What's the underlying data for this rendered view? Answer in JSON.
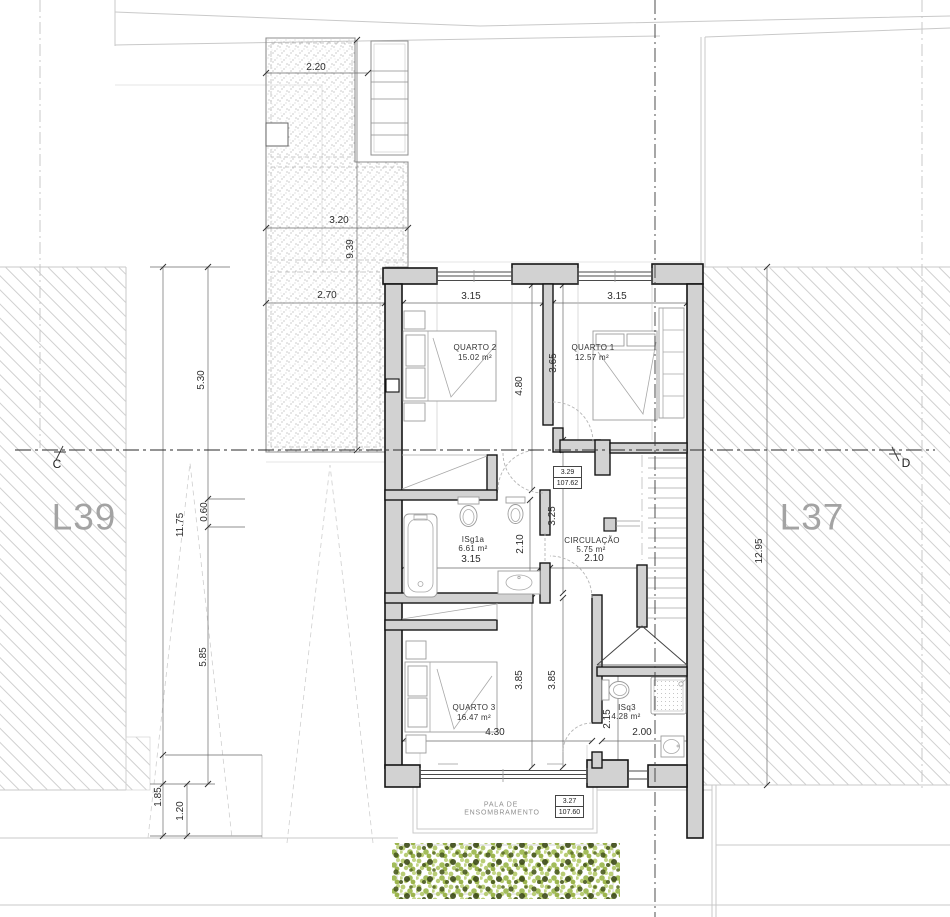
{
  "plan": {
    "lots": {
      "left": "L39",
      "right": "L37"
    },
    "section": {
      "left": "C",
      "right": "D"
    },
    "rooms": {
      "quarto2": {
        "name": "QUARTO 2",
        "area": "15.02 m²"
      },
      "quarto1": {
        "name": "QUARTO 1",
        "area": "12.57 m²"
      },
      "isg1a": {
        "name": "ISg1a",
        "area": "6.61 m²"
      },
      "circulacao": {
        "name": "CIRCULAÇÃO",
        "area": "5.75 m²"
      },
      "quarto3": {
        "name": "QUARTO 3",
        "area": "16.47 m²"
      },
      "isq3": {
        "name": "ISq3",
        "area": "4.28 m²"
      }
    },
    "canopy": {
      "line1": "PALA DE",
      "line2": "ENSOMBRAMENTO"
    },
    "levels": {
      "upper": {
        "rel": "3.29",
        "abs": "107.62"
      },
      "lower": {
        "rel": "3.27",
        "abs": "107.60"
      }
    },
    "dims": {
      "terrace_top": "2.20",
      "terrace_mid": "3.20",
      "terrace_len": "9.39",
      "terrace_bot": "2.70",
      "left_a": "5.30",
      "left_total": "11.75",
      "left_b": "0.60",
      "left_c": "5.85",
      "left_d": "1.85",
      "left_e": "1.20",
      "right_total": "12.95",
      "q2_w": "3.15",
      "q1_w": "3.15",
      "q2_h": "4.80",
      "q1_h": "3.65",
      "is_w": "3.15",
      "is_h": "2.10",
      "hall_h": "3.25",
      "circ_w": "2.10",
      "q3_h1": "3.85",
      "q3_h2": "3.85",
      "q3_w": "4.30",
      "isq3_h": "2.15",
      "isq3_w": "2.00"
    }
  }
}
